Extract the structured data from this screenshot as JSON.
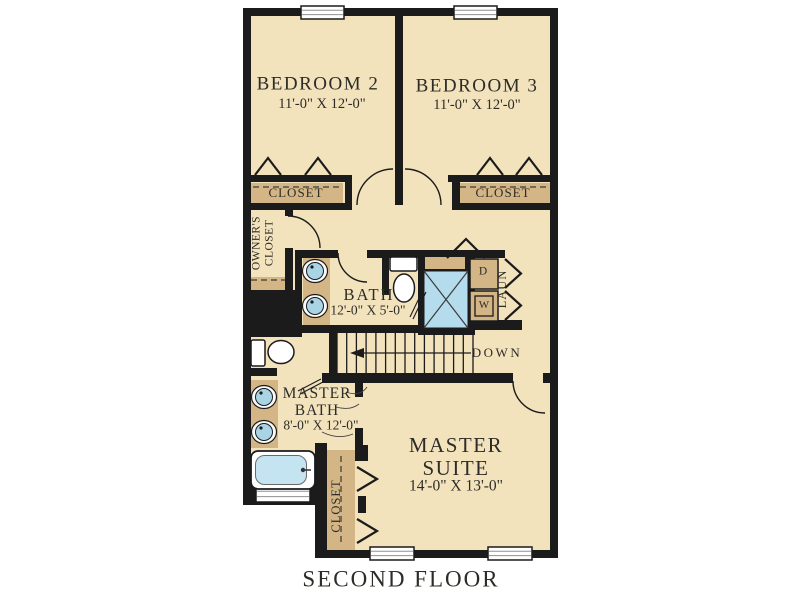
{
  "palette": {
    "floor": "#f2e3bd",
    "wall": "#1b1b1b",
    "cabinet": "#d3b586",
    "fixture_blue": "#b5dcec",
    "tub_blue": "#c4e4f2",
    "text": "#2e2c28",
    "background": "#ffffff"
  },
  "plan": {
    "title": "SECOND FLOOR",
    "bedroom2": {
      "name": "BEDROOM 2",
      "dims": "11'-0\" X 12'-0\""
    },
    "bedroom3": {
      "name": "BEDROOM 3",
      "dims": "11'-0\" X 12'-0\""
    },
    "closet_bed2": {
      "name": "CLOSET"
    },
    "closet_bed3": {
      "name": "CLOSET"
    },
    "owners_closet": {
      "line1": "OWNER'S",
      "line2": "CLOSET"
    },
    "bath": {
      "name": "BATH",
      "dims": "12'-0\" X 5'-0\""
    },
    "laundry": {
      "name": "LAUN",
      "dryer_label": "D",
      "washer_label": "W"
    },
    "stairs": {
      "direction_label": "DOWN"
    },
    "master_bath": {
      "line1": "MASTER",
      "line2": "BATH",
      "dims": "8'-0\" X 12'-0\""
    },
    "master_suite": {
      "line1": "MASTER",
      "line2": "SUITE",
      "dims": "14'-0\" X 13'-0\""
    },
    "master_closet": {
      "name": "CLOSET"
    }
  }
}
